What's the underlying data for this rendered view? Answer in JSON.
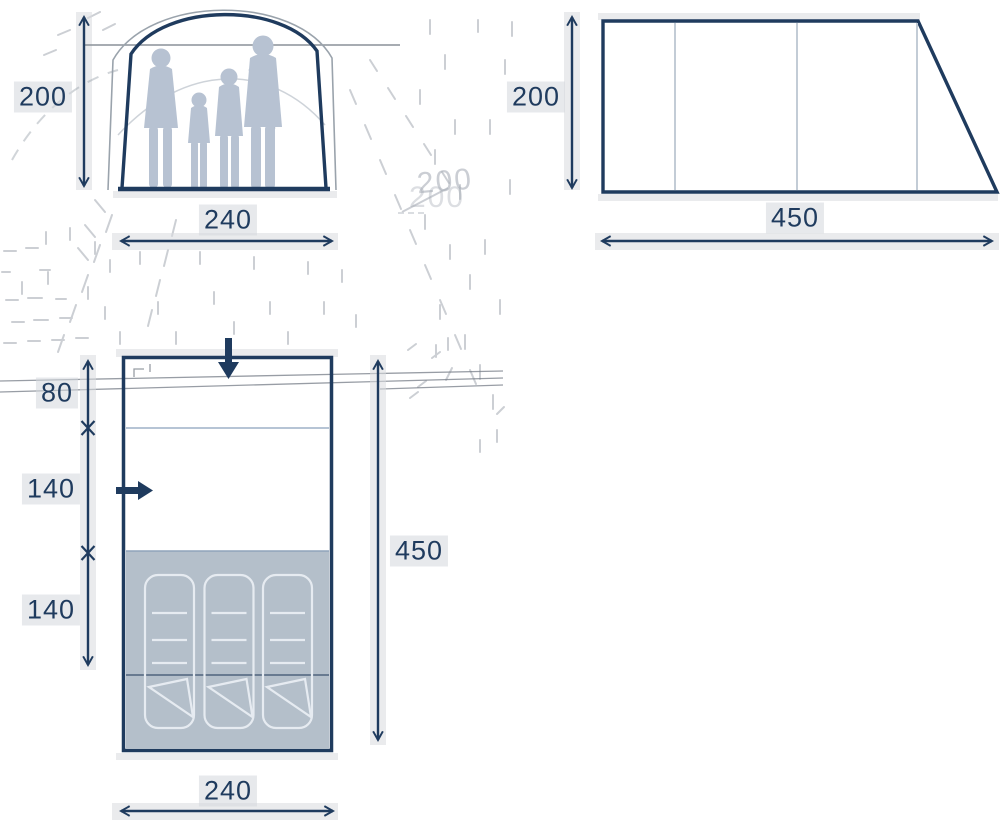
{
  "front_view": {
    "height": "200",
    "width": "240"
  },
  "side_view": {
    "height": "200",
    "length": "450"
  },
  "floor_plan": {
    "entrance_depth": "80",
    "living_depth": "140",
    "bedroom_depth": "140",
    "total_length": "450",
    "width": "240",
    "sleeping_mats": 3
  },
  "ghost": {
    "text": "200"
  },
  "colors": {
    "navy": "#1f3b5e",
    "silhouette": "#b7c2d2",
    "bedroom_fill": "#b4bfca"
  }
}
